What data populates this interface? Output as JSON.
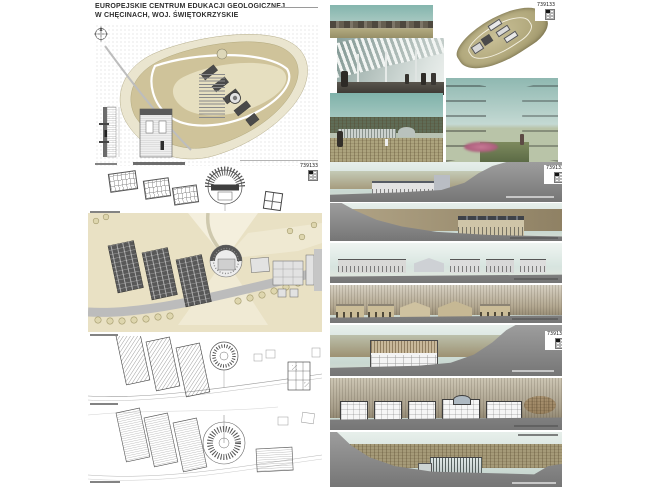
{
  "header": {
    "title_line1": "EUROPEJSKIE CENTRUM EDUKACJI GEOLOGICZNEJ",
    "title_line2": "W CHĘCINACH, WOJ. ŚWIĘTOKRZYSKIE"
  },
  "board": {
    "panel_number": "739133"
  },
  "colors": {
    "terrain_beige": "#cfc39a",
    "terrain_light": "#e6dfc0",
    "model_olive": "#afa67a",
    "sky_teal": "#7fb2aa",
    "section_gray": "#8e8e8e",
    "autumn_brown": "#9b8a6a",
    "cliff_tan": "#b3a891",
    "flower_pink": "#bc6f8e",
    "grass_green": "#6f7d52",
    "road_gray": "#b9b9b9"
  }
}
